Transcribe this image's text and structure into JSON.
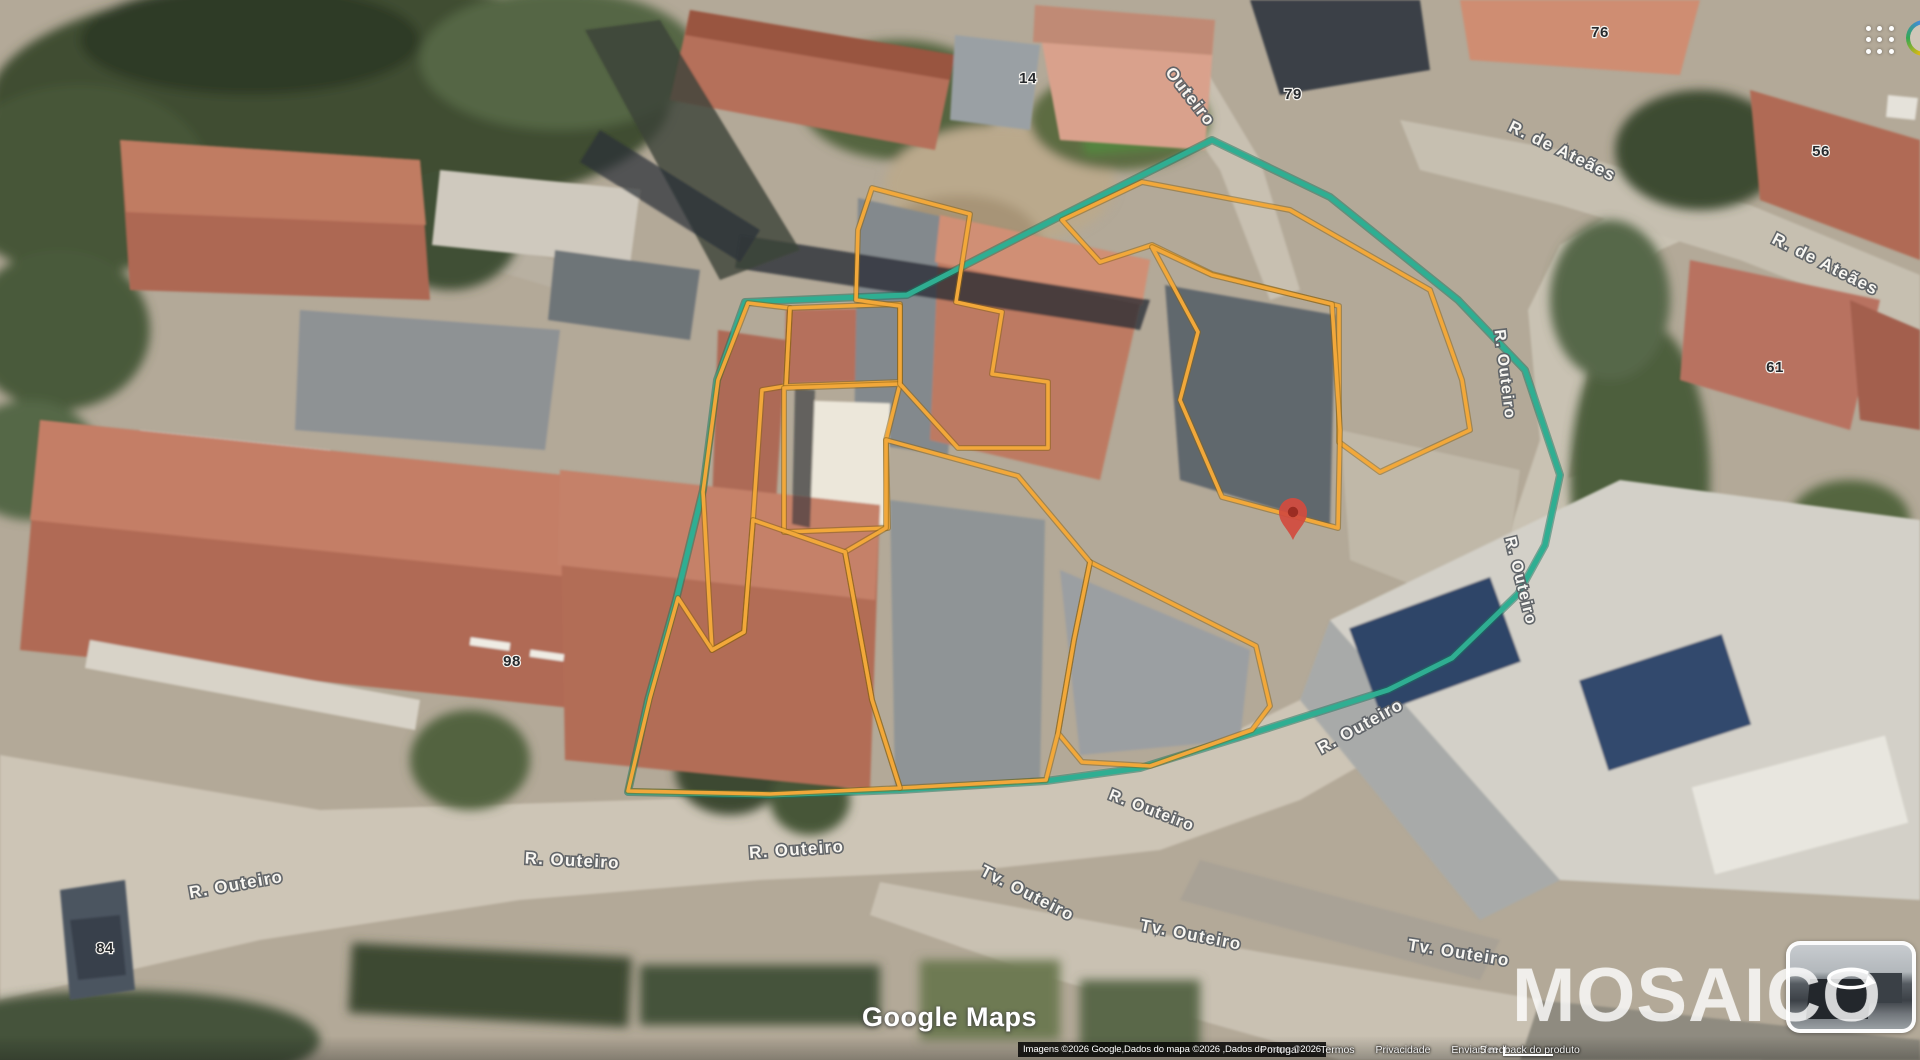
{
  "page": {
    "title": "Google Maps"
  },
  "topbar": {
    "apps_icon": "google-apps-grid",
    "avatar_icon": "account-avatar"
  },
  "watermarks": {
    "logo": "Google Maps",
    "overlay": "MOSAICO"
  },
  "attribution": {
    "imagery": "Imagens ©2026 Google,Dados do mapa ©2026 ,Dados do mapa ©2026",
    "links": [
      "Portugal",
      "Termos",
      "Privacidade",
      "Enviar feedback do produto"
    ],
    "scale_label": "5 m"
  },
  "rotate_widget": {
    "icon": "rotate-view-3d"
  },
  "map": {
    "colors": {
      "boundary": "#2fae92",
      "boundary_halo": "#17735e",
      "parcel": "#f2a83a",
      "parcel_halo": "#8a6212",
      "pin": "#d24b3e",
      "pin_inner": "#96291f",
      "street_label_fill": "#fbfaf6",
      "street_label_outline": "#5d6166",
      "number_fill": "#26292c"
    },
    "boundary": {
      "points": "1212,140 1330,197 1458,300 1525,370 1560,475 1545,545 1518,594 1452,658 1388,690 1253,733 1140,768 1046,781 900,790 770,795 628,792 648,700 676,600 703,490 717,380 745,302 907,295 1057,218"
    },
    "parcels": [
      {
        "points": "748,303 790,308 786,386 762,390 753,520 744,632 712,650 703,492 718,380"
      },
      {
        "points": "790,308 900,304 900,382 786,386"
      },
      {
        "points": "784,388 900,384 886,440 888,528 784,532"
      },
      {
        "points": "856,300 858,230 872,188 970,214 956,302 1002,312 992,374 1048,382 1048,448 958,448 900,384 900,306"
      },
      {
        "points": "1062,220 1142,182 1290,210 1430,290 1462,380 1470,430 1380,472 1339,442 1339,306 1212,274 1152,245 1100,262"
      },
      {
        "points": "1152,247 1212,275 1332,304 1340,430 1338,528 1222,497 1180,400 1198,332"
      },
      {
        "points": "1090,562 1256,646 1270,706 1252,730 1150,766 1082,762 1058,733 1074,640"
      },
      {
        "points": "886,440 1018,476 1090,562 1074,640 1058,733 1046,780 900,788 872,700 845,552 886,528"
      },
      {
        "points": "712,650 744,632 753,520 845,552 872,700 900,788 770,794 628,791 650,698 678,598"
      }
    ],
    "pin": {
      "x": 1293,
      "y": 540
    },
    "street_labels": [
      {
        "text": "Outeiro",
        "x": 1186,
        "y": 100,
        "rot": 52,
        "size": 17
      },
      {
        "text": "R. de Ateães",
        "x": 1560,
        "y": 156,
        "rot": 26,
        "size": 17
      },
      {
        "text": "R. de Ateães",
        "x": 1823,
        "y": 269,
        "rot": 27,
        "size": 17
      },
      {
        "text": "R. Outeiro",
        "x": 1500,
        "y": 375,
        "rot": 83,
        "size": 16
      },
      {
        "text": "R. Outeiro",
        "x": 1516,
        "y": 582,
        "rot": 76,
        "size": 16
      },
      {
        "text": "R. Outeiro",
        "x": 1363,
        "y": 731,
        "rot": -29,
        "size": 17
      },
      {
        "text": "R. Outeiro",
        "x": 1150,
        "y": 815,
        "rot": 21,
        "size": 16
      },
      {
        "text": "Tv. Outeiro",
        "x": 1025,
        "y": 898,
        "rot": 27,
        "size": 17
      },
      {
        "text": "Tv. Outeiro",
        "x": 1190,
        "y": 940,
        "rot": 11,
        "size": 17
      },
      {
        "text": "Tv. Outeiro",
        "x": 1458,
        "y": 958,
        "rot": 9,
        "size": 17
      },
      {
        "text": "R. Outeiro",
        "x": 237,
        "y": 890,
        "rot": -10,
        "size": 17
      },
      {
        "text": "R. Outeiro",
        "x": 572,
        "y": 866,
        "rot": 3,
        "size": 17
      },
      {
        "text": "R. Outeiro",
        "x": 797,
        "y": 855,
        "rot": -4,
        "size": 17
      }
    ],
    "house_numbers": [
      {
        "text": "14",
        "x": 1028,
        "y": 78
      },
      {
        "text": "79",
        "x": 1293,
        "y": 94
      },
      {
        "text": "76",
        "x": 1600,
        "y": 32
      },
      {
        "text": "56",
        "x": 1821,
        "y": 151
      },
      {
        "text": "61",
        "x": 1775,
        "y": 367
      },
      {
        "text": "98",
        "x": 512,
        "y": 661
      },
      {
        "text": "84",
        "x": 105,
        "y": 948
      }
    ]
  }
}
